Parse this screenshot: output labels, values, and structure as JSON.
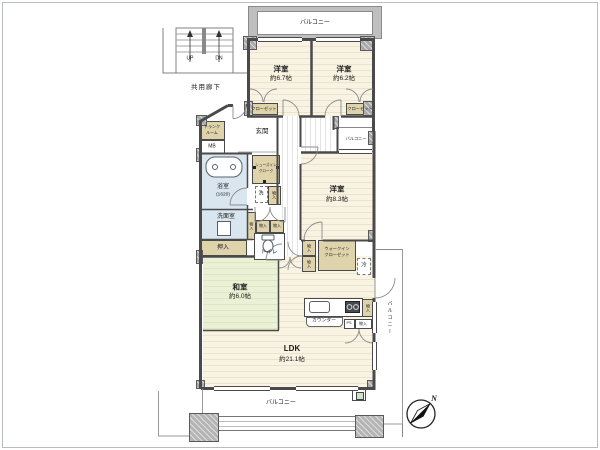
{
  "plan": {
    "stairwell": {
      "up_label": "UP",
      "down_label": "DN",
      "corridor_label": "共用廊下"
    },
    "balcony_label": "バルコニー",
    "rooms": {
      "west1": {
        "name": "洋室",
        "size": "約6.7帖"
      },
      "west2": {
        "name": "洋室",
        "size": "約6.2帖"
      },
      "west3": {
        "name": "洋室",
        "size": "約8.3帖"
      },
      "japanese": {
        "name": "和室",
        "size": "約6.0帖"
      },
      "ldk": {
        "name": "LDK",
        "size": "約21.1帖"
      },
      "bath": {
        "name": "浴室",
        "size_note": "(1620)"
      },
      "washroom_label": "洗面室",
      "toilet_label": "トイレ",
      "genkan_label": "玄関"
    },
    "storage": {
      "oshiire": "押入",
      "mono": "物入",
      "closet": "クローゼット",
      "wic_line1": "ウォークイン",
      "wic_line2": "クローゼット",
      "trunk_line1": "トランク",
      "trunk_line2": "ルーム",
      "sic_line1": "シューズイン",
      "sic_line2": "クローク"
    },
    "fixtures": {
      "mb": "MB",
      "washer": "洗",
      "fridge": "冷",
      "counter": "カウンター",
      "ps": "PS"
    },
    "compass": {
      "north": "N"
    },
    "colors": {
      "wall": "#4a4a4a",
      "column": "#a9a9a9",
      "western_room": "#f8f3e2",
      "tatami": "#ebf1d7",
      "wet_area": "#d9e6f0",
      "storage": "#ded3ab"
    }
  }
}
